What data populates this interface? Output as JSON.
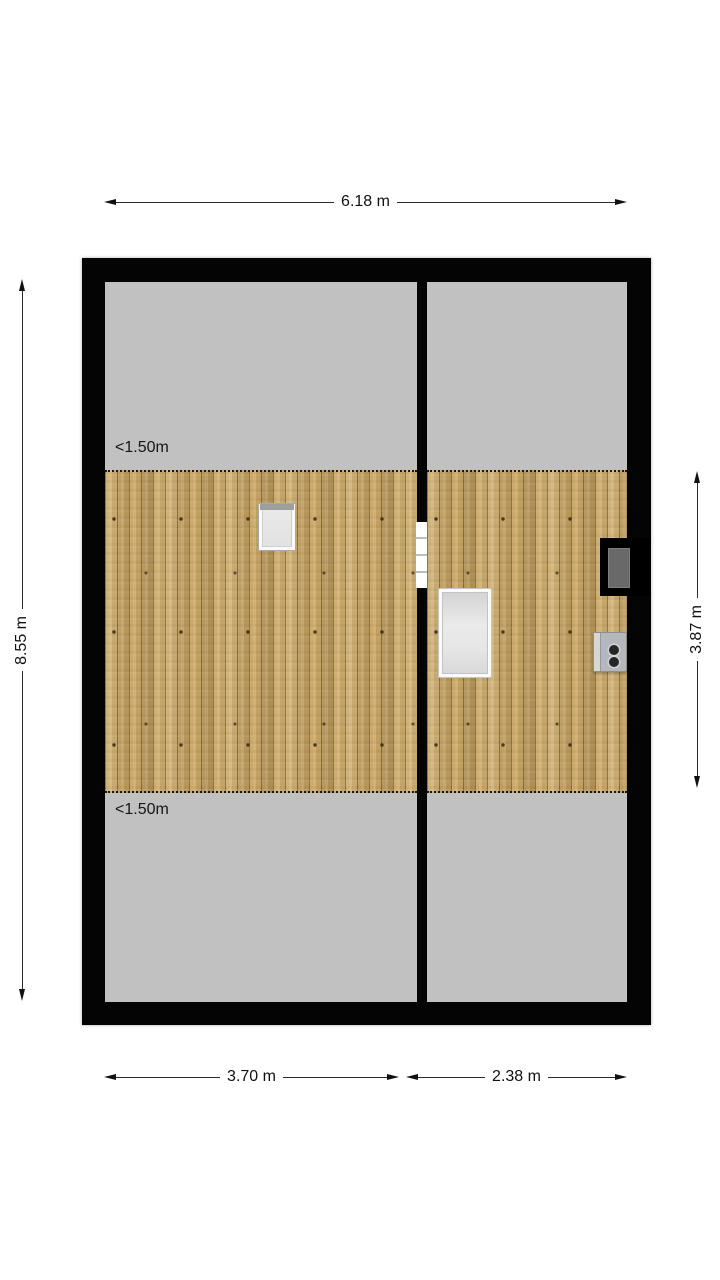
{
  "dimensions": {
    "total_width": "6.18 m",
    "total_height": "8.55 m",
    "headroom_height": "3.87 m",
    "room_left_width": "3.70 m",
    "room_right_width": "2.38 m"
  },
  "labels": {
    "headroom_top": "<1.50m",
    "headroom_bottom": "<1.50m"
  },
  "colors": {
    "wall": "#000000",
    "low_headroom_zone": "#c1c1c1",
    "wood_floor": "#c8a669",
    "dimension_text": "#111111",
    "background": "#ffffff"
  }
}
